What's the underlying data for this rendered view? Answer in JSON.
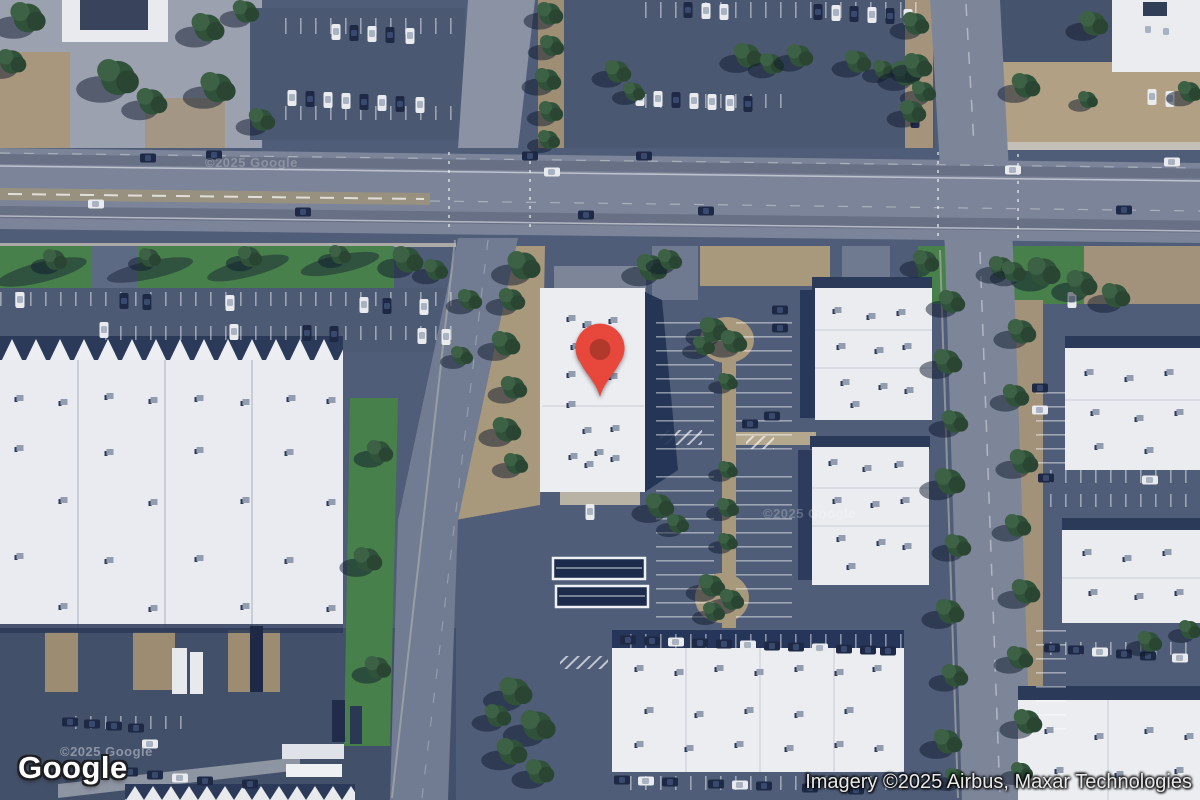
{
  "map": {
    "type": "satellite-imagery",
    "description": "Aerial satellite view of a commercial/industrial block with a red location marker on a white-roofed building near a main road intersection",
    "marker": {
      "x": 600,
      "y": 400,
      "color": "#E8483B",
      "inner_dot_color": "#B0392B"
    },
    "watermark_text": "©2025 Google",
    "palette": {
      "asphalt": "#4F5D78",
      "road": "#7B8498",
      "roof_white": "#EBEDF1",
      "grass": "#47804A",
      "tree": "#31523A",
      "dirt": "#AB9A7E",
      "shadow_navy": "#22325200"
    }
  },
  "branding": {
    "google_logo": "Google"
  },
  "attribution": {
    "imagery_credit": "Imagery ©2025 Airbus, Maxar Technologies"
  }
}
